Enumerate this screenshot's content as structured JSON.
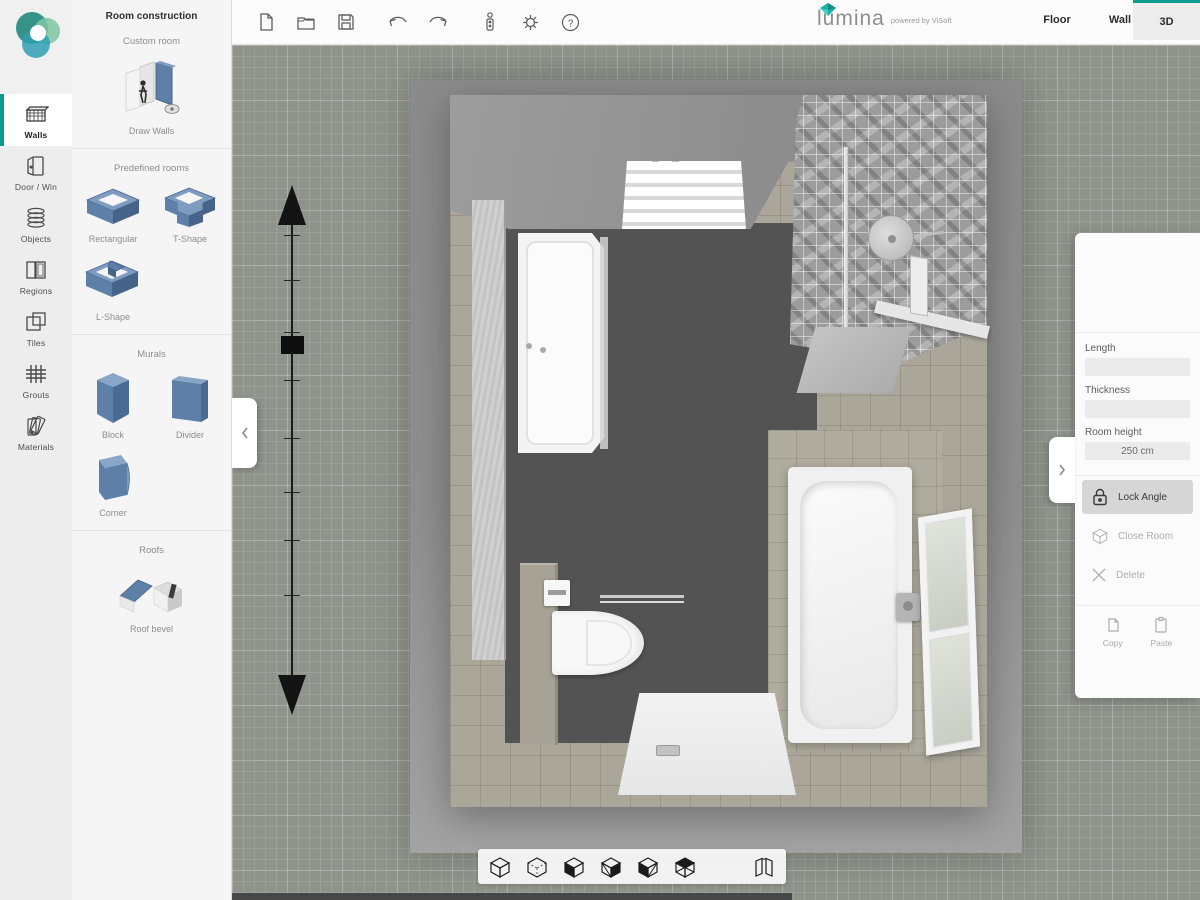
{
  "accent": "#0d9b90",
  "brand": {
    "name": "lumina",
    "powered": "powered by ViSoft"
  },
  "header": {
    "tabs": [
      {
        "label": "Floor",
        "active": false
      },
      {
        "label": "Wall",
        "active": false
      },
      {
        "label": "3D",
        "active": true
      }
    ]
  },
  "toolbar": {
    "icons": [
      "new-file",
      "open-folder",
      "save",
      "undo",
      "redo",
      "usb-device",
      "settings",
      "help"
    ],
    "help_glyph": "?"
  },
  "sidebar": {
    "items": [
      {
        "label": "Walls",
        "icon": "wall-icon",
        "active": true
      },
      {
        "label": "Door / Win",
        "icon": "door-icon",
        "active": false
      },
      {
        "label": "Objects",
        "icon": "objects-icon",
        "active": false
      },
      {
        "label": "Regions",
        "icon": "regions-icon",
        "active": false
      },
      {
        "label": "Tiles",
        "icon": "tiles-icon",
        "active": false
      },
      {
        "label": "Grouts",
        "icon": "grouts-icon",
        "active": false
      },
      {
        "label": "Materials",
        "icon": "materials-icon",
        "active": false
      }
    ]
  },
  "panel": {
    "title": "Room construction",
    "sections": [
      {
        "label": "Custom room",
        "items": [
          {
            "label": "Draw Walls"
          }
        ]
      },
      {
        "label": "Predefined rooms",
        "items": [
          {
            "label": "Rectangular"
          },
          {
            "label": "T-Shape"
          },
          {
            "label": "L-Shape"
          }
        ]
      },
      {
        "label": "Murals",
        "items": [
          {
            "label": "Block"
          },
          {
            "label": "Divider"
          },
          {
            "label": "Corner"
          }
        ]
      },
      {
        "label": "Roofs",
        "items": [
          {
            "label": "Roof bevel"
          }
        ]
      }
    ]
  },
  "props": {
    "fields": [
      {
        "label": "Length",
        "value": ""
      },
      {
        "label": "Thickness",
        "value": ""
      },
      {
        "label": "Room height",
        "value": "250 cm"
      }
    ],
    "actions": [
      {
        "label": "Lock Angle",
        "state": "selected"
      },
      {
        "label": "Close Room",
        "state": "disabled"
      },
      {
        "label": "Delete",
        "state": "disabled"
      }
    ],
    "clipboard": [
      {
        "label": "Copy"
      },
      {
        "label": "Paste"
      }
    ]
  },
  "scene": {
    "objects": [
      "shower-enclosure",
      "radiator",
      "shower-head",
      "mosaic-wall",
      "bathtub",
      "window",
      "toilet",
      "toilet-paper-holder",
      "grab-bar",
      "entrance-floor"
    ],
    "colors": {
      "grid": "#8e938b",
      "floor": "#535353",
      "wall_tiles": "#aaa79a",
      "platform": "#8f8f8f"
    }
  }
}
